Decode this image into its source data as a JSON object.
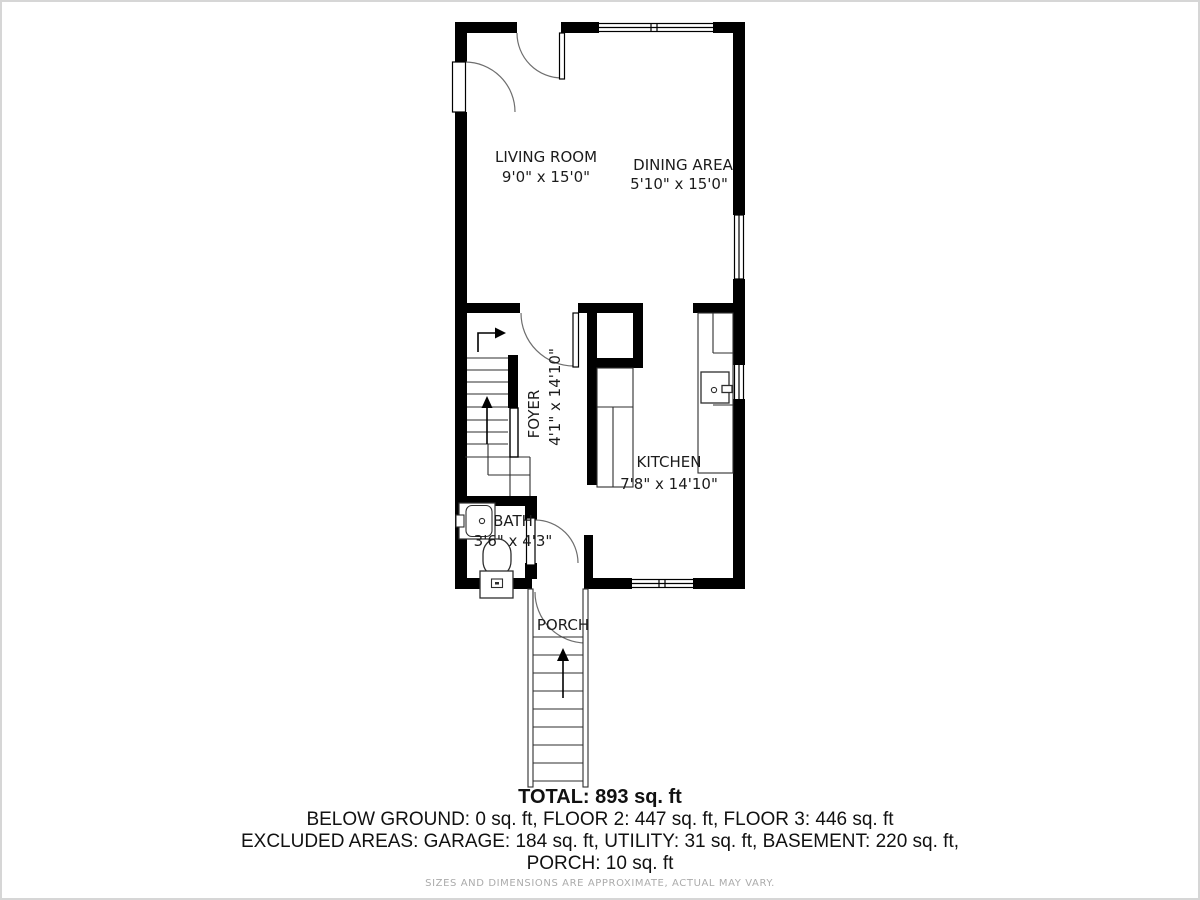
{
  "page": {
    "background": "#ffffff",
    "frame_color": "#d6d6d6"
  },
  "floor_plan": {
    "wall_color": "#000000",
    "thin_line_color": "#2e2e2e",
    "arc_color": "#6e6e6e",
    "rooms": [
      {
        "id": "living-room",
        "name": "LIVING ROOM",
        "dimensions": "9'0\" x 15'0\""
      },
      {
        "id": "dining-area",
        "name": "DINING AREA",
        "dimensions": "5'10\" x 15'0\""
      },
      {
        "id": "foyer",
        "name": "FOYER",
        "dimensions": "4'1\" x 14'10\""
      },
      {
        "id": "kitchen",
        "name": "KITCHEN",
        "dimensions": "7'8\" x 14'10\""
      },
      {
        "id": "bath",
        "name": "BATH",
        "dimensions": "3'6\" x 4'3\""
      },
      {
        "id": "porch",
        "name": "PORCH",
        "dimensions": ""
      }
    ]
  },
  "summary": {
    "total": "TOTAL: 893 sq. ft",
    "floors_line": "BELOW GROUND: 0 sq. ft, FLOOR 2: 447 sq. ft, FLOOR 3: 446 sq. ft",
    "excluded_line": "EXCLUDED AREAS: GARAGE: 184 sq. ft, UTILITY: 31 sq. ft, BASEMENT: 220 sq. ft,",
    "excluded_line2": "PORCH: 10 sq. ft",
    "disclaimer": "SIZES AND DIMENSIONS ARE APPROXIMATE, ACTUAL MAY VARY."
  }
}
